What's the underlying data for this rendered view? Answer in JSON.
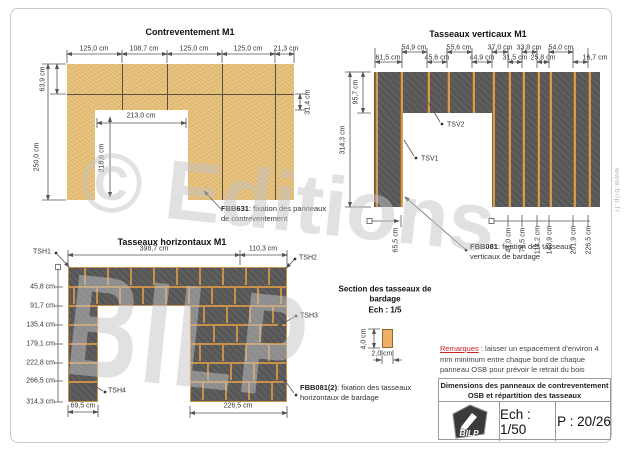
{
  "watermark": {
    "line1": "© Editions",
    "line2": "BILP"
  },
  "site": "www.bilp.fr",
  "contreventement": {
    "title": "Contreventement M1",
    "top_dims": [
      "125,0 cm",
      "108,7 cm",
      "125,0 cm",
      "125,0 cm",
      "21,3 cm"
    ],
    "left_dim_top": "63,9 cm",
    "left_dim_total": "250,0 cm",
    "right_dim": "31,4 cm",
    "door_width": "213,0 cm",
    "door_height": "218,6 cm",
    "note_code": "FBB631",
    "note_text": ": fixation des panneaux",
    "note_text2": "de contreventement"
  },
  "verticaux": {
    "title": "Tasseaux verticaux M1",
    "top_dims_row1": [
      "54,9 cm",
      "55,6 cm",
      "37,0 cm",
      "33,8 cm",
      "54,0 cm"
    ],
    "top_dims_row2": [
      "61,5 cm",
      "45,6 cm",
      "44,9 cm",
      "31,5 cm",
      "25,8 cm",
      "16,7 cm"
    ],
    "left_dim_top": "95,7 cm",
    "left_dim_total": "314,3 cm",
    "bottom_left_dim": "65,5 cm",
    "bottom_dims": [
      "41,0 cm",
      "76,5 cm",
      "114,2 cm",
      "143,9 cm",
      "201,9 cm",
      "226,5 cm"
    ],
    "tsv1": "TSV1",
    "tsv2": "TSV2",
    "note_code": "FBB081",
    "note_text": ": fixation des tasseaux",
    "note_text2": "verticaux de bardage"
  },
  "horizontaux": {
    "title": "Tasseaux horizontaux M1",
    "top_dims": [
      "398,7 cm",
      "110,3 cm"
    ],
    "left_dims": [
      "45,8 cm",
      "91,7 cm",
      "135,4 cm",
      "179,1 cm",
      "222,8 cm",
      "266,5 cm",
      "314,3 cm"
    ],
    "bottom_dims": [
      "69,5 cm",
      "226,5 cm"
    ],
    "tsh1": "TSH1",
    "tsh2": "TSH2",
    "tsh3": "TSH3",
    "tsh4": "TSH4",
    "note_code": "FBB081(2)",
    "note_text": ": fixation des tasseaux",
    "note_text2": "horizontaux de bardage"
  },
  "section": {
    "title_line1": "Section des tasseaux de",
    "title_line2": "bardage",
    "title_line3": "Ech : 1/5",
    "height_dim": "4,0 cm",
    "width_dim": "2,0 cm"
  },
  "remarques": {
    "label": "Remarques",
    "sep": " : ",
    "text": "laisser un espacement d'environ 4 mm minimum entre chaque bord de chaque panneau OSB pour prévoir le retrait du bois"
  },
  "titleblock": {
    "title_line1": "Dimensions des panneaux de contreventement",
    "title_line2": "OSB et répartition des tasseaux",
    "logo": "BILP",
    "scale": "Ech : 1/50",
    "page": "P : 20/26"
  },
  "colors": {
    "osb": "#e8c17b",
    "panel_dark": "#5e5e5e",
    "tasseau_orange": "#d89a4f",
    "remark_red": "#cc2222",
    "dim_line": "#555555"
  }
}
